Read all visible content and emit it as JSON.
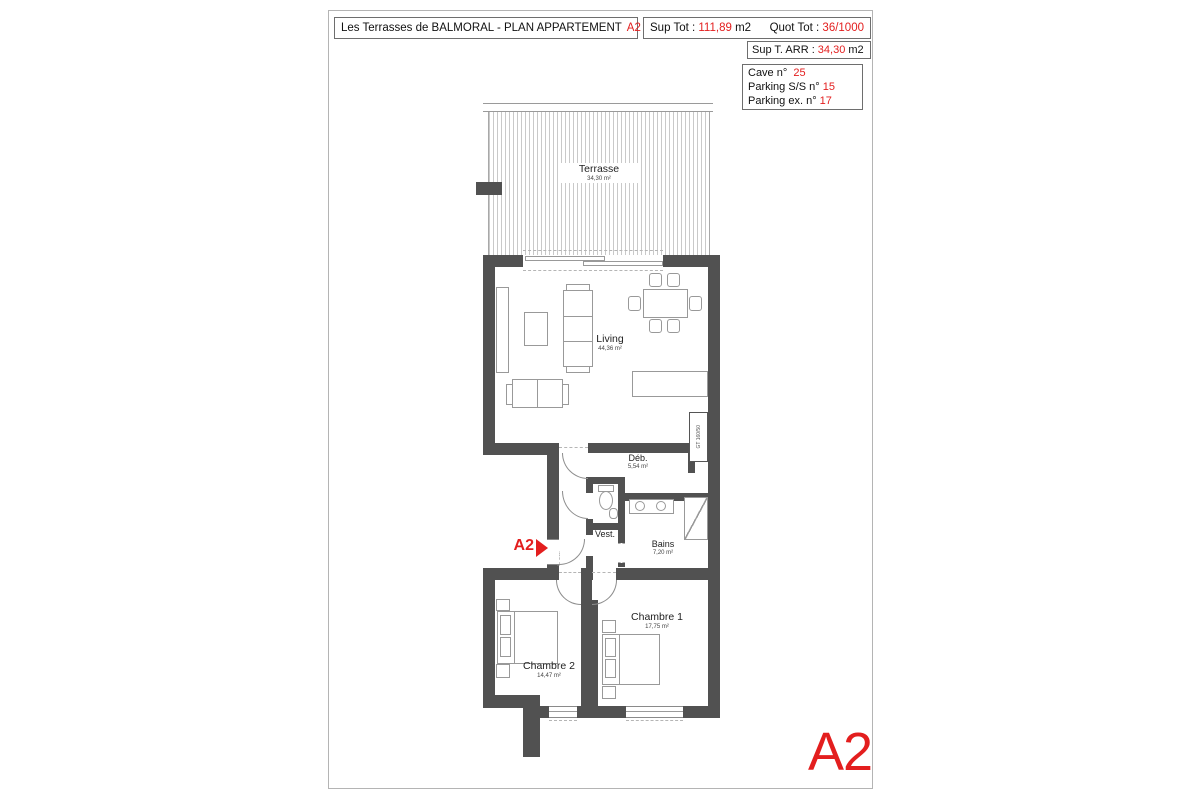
{
  "header": {
    "title": {
      "text": "Les Terrasses de BALMORAL - PLAN APPARTEMENT",
      "unit": "A2"
    },
    "sup_tot": {
      "label": "Sup Tot :",
      "value": "111,89",
      "unit": "m2"
    },
    "quot_tot": {
      "label": "Quot Tot :",
      "value": "36/1000"
    },
    "sup_arr": {
      "label": "Sup T. ARR :",
      "value": "34,30",
      "unit": "m2"
    },
    "annexes": [
      {
        "label": "Cave n°",
        "value": "25"
      },
      {
        "label": "Parking S/S n°",
        "value": "15"
      },
      {
        "label": "Parking ex. n°",
        "value": "17"
      }
    ]
  },
  "plan": {
    "rooms": [
      {
        "name": "Terrasse",
        "area": "34,30 m²"
      },
      {
        "name": "Living",
        "area": "44,36 m²"
      },
      {
        "name": "Déb.",
        "area": "5,54 m²"
      },
      {
        "name": "Vest.",
        "area": ""
      },
      {
        "name": "Bains",
        "area": "7,20 m²"
      },
      {
        "name": "Chambre 1",
        "area": "17,75 m²"
      },
      {
        "name": "Chambre 2",
        "area": "14,47 m²"
      }
    ],
    "entrance_label": "A2",
    "duct_label": "GT 160/50",
    "door_fire_label": "Rf 1/2h"
  },
  "footer": {
    "unit_label": "A2"
  },
  "colors": {
    "accent": "#e31e1e",
    "wall": "#515151"
  }
}
